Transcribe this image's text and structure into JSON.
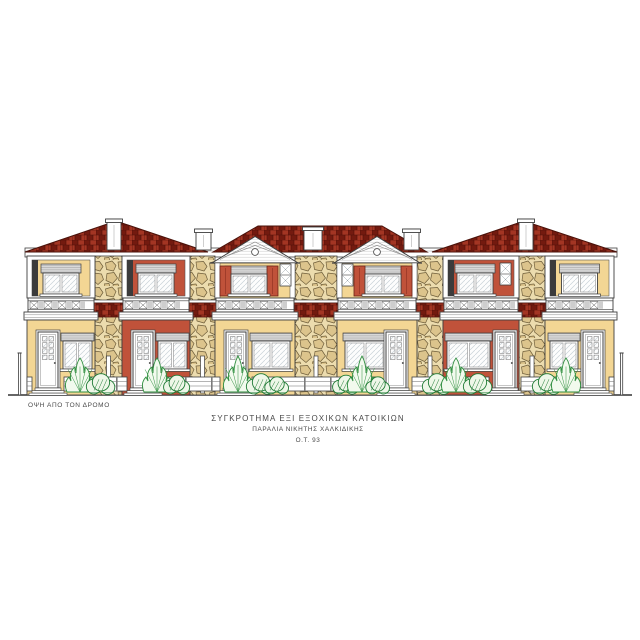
{
  "drawing": {
    "type": "architectural-elevation-front-view",
    "view_label": "ΟΨΗ ΑΠΟ ΤΟΝ ΔΡΟΜΟ",
    "title": "ΣΥΓΚΡΟΤΗΜΑ ΕΞΙ ΕΞΟΧΙΚΩΝ ΚΑΤΟΙΚΙΩΝ",
    "subtitle": "ΠΑΡΑΛΙΑ ΝΙΚΗΤΗΣ ΧΑΛΚΙΔΙΚΗΣ",
    "block_label": "Ο.Τ. 93",
    "unit_count": 6
  },
  "palette": {
    "wall_yellow": "#f3d694",
    "wall_red": "#c0523a",
    "roof_dark": "#731a0f",
    "roof_mid": "#8f2a1b",
    "roof_light": "#a33523",
    "roof_joint": "#4f0f08",
    "stone_bg": "#ecdcae",
    "stone_fill": "#dcc48c",
    "stone_line": "#6f5e3a",
    "shutter_box_gray": "#d8d8d8",
    "line": "#3f3f3f",
    "shadow_dark": "#3b3b3b",
    "glass_line": "#c9d2d8",
    "tree_green": "#2f8f3f",
    "bush_green": "#1e7a34",
    "text": "#4a4a4a"
  },
  "units": [
    {
      "id": 1,
      "upper": {
        "style": "loggia",
        "wall": "yellow",
        "small_window": null
      },
      "ground": {
        "wall": "yellow",
        "door": "left"
      }
    },
    {
      "id": 2,
      "upper": {
        "style": "loggia",
        "wall": "red",
        "small_window": null
      },
      "ground": {
        "wall": "red",
        "door": "left"
      }
    },
    {
      "id": 3,
      "upper": {
        "style": "pediment",
        "wall": "yellow",
        "shutters": true,
        "small_window": "right"
      },
      "ground": {
        "wall": "yellow",
        "door": "left"
      }
    },
    {
      "id": 4,
      "upper": {
        "style": "pediment",
        "wall": "yellow",
        "shutters": true,
        "small_window": "left"
      },
      "ground": {
        "wall": "yellow",
        "door": "right"
      }
    },
    {
      "id": 5,
      "upper": {
        "style": "loggia",
        "wall": "red",
        "small_window": "right"
      },
      "ground": {
        "wall": "red",
        "door": "right"
      }
    },
    {
      "id": 6,
      "upper": {
        "style": "loggia",
        "wall": "yellow",
        "small_window": null
      },
      "ground": {
        "wall": "yellow",
        "door": "right"
      }
    }
  ]
}
